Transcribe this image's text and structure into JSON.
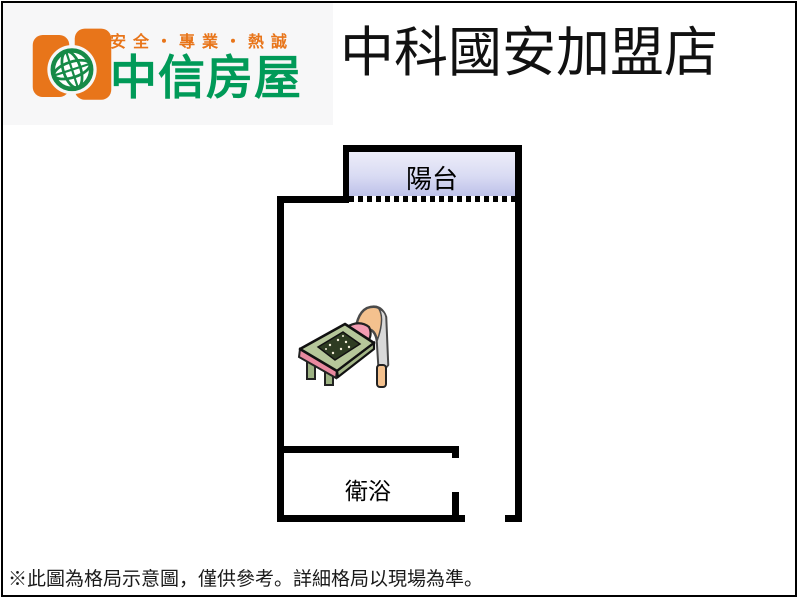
{
  "header": {
    "slogan": "安全・專業・熱誠",
    "brand_name": "中信房屋",
    "store_name": "中科國安加盟店",
    "colors": {
      "slogan_orange": "#e8751a",
      "brand_green": "#009a58",
      "logo_orange": "#e8751a",
      "logo_globe_green": "#168a47"
    }
  },
  "floorplan": {
    "balcony_label": "陽台",
    "bathroom_label": "衛浴",
    "colors": {
      "wall": "#000000",
      "balcony_fill_top": "#edf0fa",
      "balcony_fill_bottom": "#bdc1e9"
    },
    "features": [
      "balcony with dotted sliding-door sill",
      "main room with single bed clipart",
      "bathroom at bottom-left with door opening",
      "entry door gap at bottom-right"
    ]
  },
  "footer": {
    "disclaimer": "※此圖為格局示意圖，僅供參考。詳細格局以現場為準。"
  }
}
